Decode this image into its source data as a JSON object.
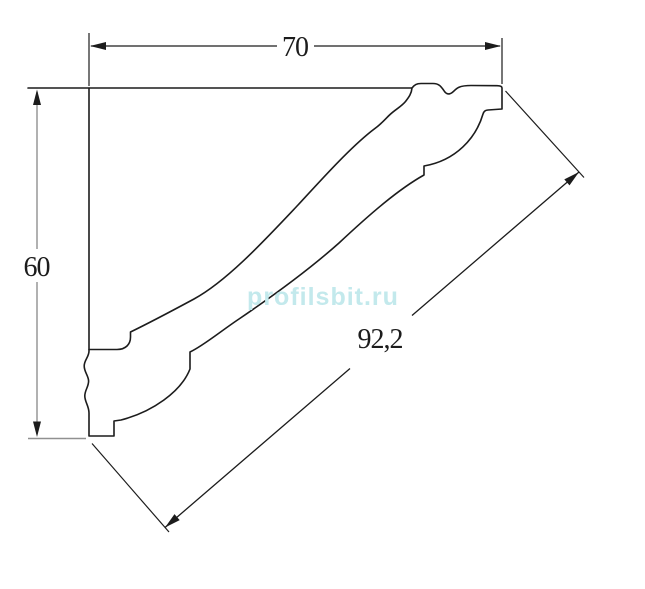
{
  "drawing": {
    "dimensions": {
      "width": {
        "label": "70"
      },
      "height": {
        "label": "60"
      },
      "diagonal": {
        "label": "92,2"
      }
    },
    "watermark": {
      "text": "profilsbit.ru"
    },
    "colors": {
      "line": "#1c1c1c",
      "secondary_line": "#909090",
      "watermark": "#c3e9ec",
      "background": "#ffffff"
    }
  }
}
